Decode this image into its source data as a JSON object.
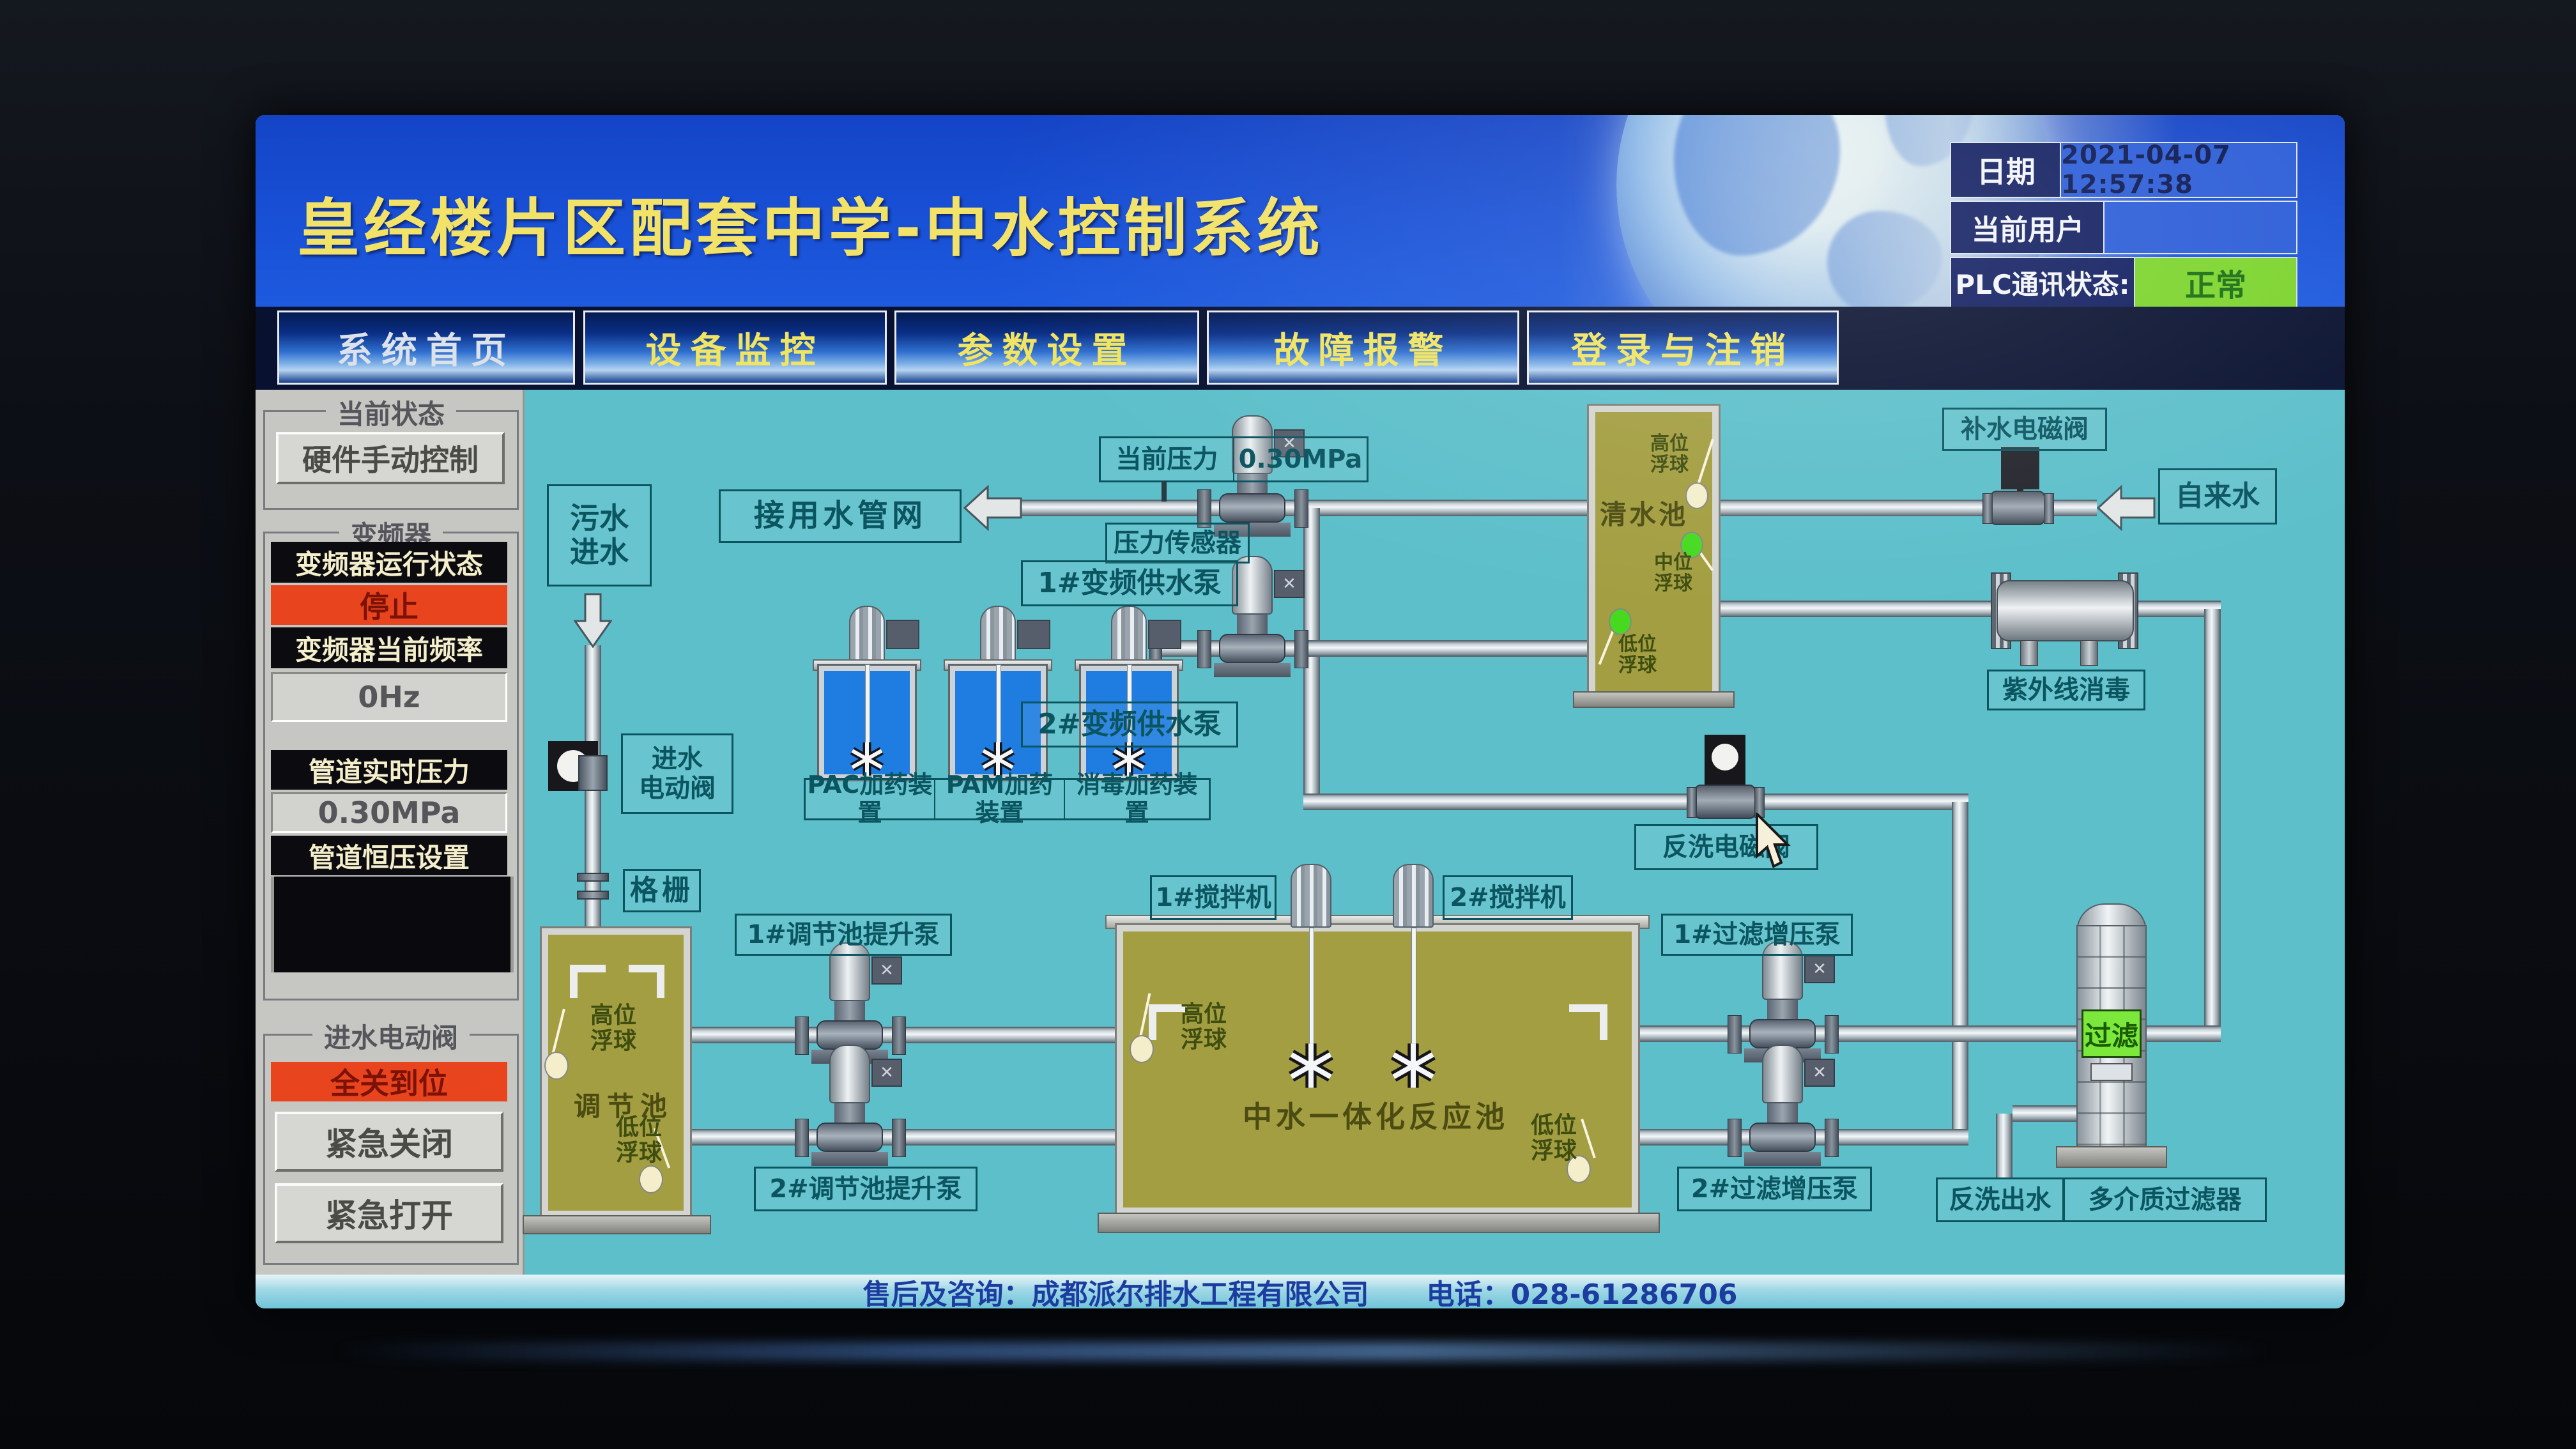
{
  "header": {
    "title": "皇经楼片区配套中学-中水控制系统",
    "date_label": "日期",
    "date_value": "2021-04-07 12:57:38",
    "user_label": "当前用户",
    "user_value": "",
    "plc_label": "PLC通讯状态:",
    "plc_status": "正常"
  },
  "nav": {
    "tabs": [
      {
        "label": "系统首页"
      },
      {
        "label": "设备监控"
      },
      {
        "label": "参数设置"
      },
      {
        "label": "故障报警"
      },
      {
        "label": "登录与注销"
      }
    ]
  },
  "sidebar": {
    "current_status_group": "当前状态",
    "manual_button": "硬件手动控制",
    "vfd_group": "变频器",
    "vfd_run_label": "变频器运行状态",
    "vfd_run_value": "停止",
    "vfd_freq_label": "变频器当前频率",
    "vfd_freq_value": "0Hz",
    "pipe_pressure_label": "管道实时压力",
    "pipe_pressure_value": "0.30MPa",
    "pressure_set_label": "管道恒压设置",
    "pressure_set_value": "",
    "inlet_valve_group": "进水电动阀",
    "inlet_valve_status": "全关到位",
    "emergency_close": "紧急关闭",
    "emergency_open": "紧急打开"
  },
  "diagram": {
    "sewage_inlet": "污水\n进水",
    "network_box": "接用水管网",
    "current_pressure_label": "当前压力",
    "current_pressure_value": "0.30MPa",
    "pressure_sensor": "压力传感器",
    "inlet_valve": "进水\n电动阀",
    "grid_screen": "格栅",
    "dosing_labels": [
      {
        "label": "PAC加药装置"
      },
      {
        "label": "PAM加药装置"
      },
      {
        "label": "消毒加药装置"
      }
    ],
    "supply_pump_1": "1#变频供水泵",
    "supply_pump_2": "2#变频供水泵",
    "clear_tank": "清水池",
    "float_high": "高位\n浮球",
    "float_mid": "中位\n浮球",
    "float_low": "低位\n浮球",
    "makeup_valve": "补水电磁阀",
    "tap_water": "自来水",
    "uv_disinfect": "紫外线消毒",
    "backwash_valve": "反洗电磁阀",
    "reg_tank": "调节池",
    "lift_pump_1": "1#调节池提升泵",
    "lift_pump_2": "2#调节池提升泵",
    "mixer_1": "1#搅拌机",
    "mixer_2": "2#搅拌机",
    "reaction_tank": "中水一体化反应池",
    "filter_pump_1": "1#过滤增压泵",
    "filter_pump_2": "2#过滤增压泵",
    "filter_state": "过滤",
    "backwash_out": "反洗出水",
    "media_filter": "多介质过滤器"
  },
  "footer": {
    "service_text": "售后及咨询：成都派尔排水工程有限公司",
    "phone_text": "电话：028-61286706"
  },
  "colors": {
    "accent_yellow": "#f2e268",
    "status_run_green": "#7cd42c",
    "status_stop_red": "#e8441e",
    "diagram_teal": "#5cbfca",
    "tank_olive": "#a39e41",
    "filter_green": "#7ce83c"
  }
}
